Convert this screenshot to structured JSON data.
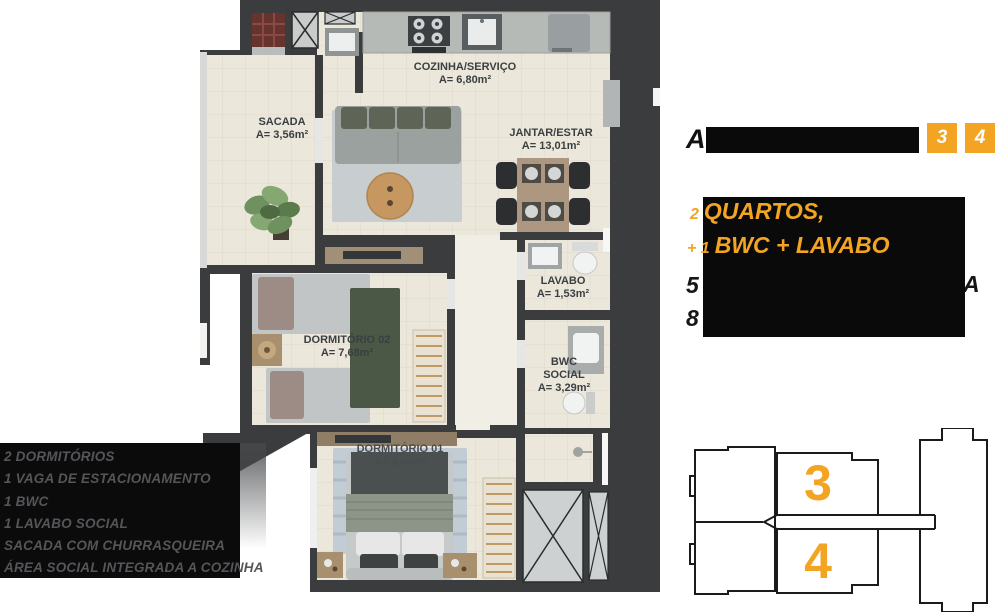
{
  "panel": {
    "accent_color": "#F2A422",
    "title_visible_prefix": "A",
    "unit_badges": [
      "3",
      "4"
    ],
    "highlight": {
      "line1_prefix": "2",
      "line1_text": "QUARTOS,",
      "line2_prefix": "+ 1",
      "line2_text": "BWC + LAVABO"
    },
    "partially_redacted": {
      "line3_prefix": "5",
      "line3_suffix": "A",
      "line4_prefix": "8"
    }
  },
  "features": {
    "items": [
      "2 DORMITÓRIOS",
      "1 VAGA DE ESTACIONAMENTO",
      "1 BWC",
      "1 LAVABO SOCIAL",
      "SACADA COM CHURRASQUEIRA",
      "ÁREA SOCIAL INTEGRADA A COZINHA"
    ]
  },
  "floorplan": {
    "wall_color": "#3A3C3E",
    "floor_color": "#ECE7DB",
    "rooms": [
      {
        "name": "SACADA",
        "area": "A= 3,56m²"
      },
      {
        "name": "COZINHA/SERVIÇO",
        "area": "A= 6,80m²"
      },
      {
        "name": "JANTAR/ESTAR",
        "area": "A= 13,01m²"
      },
      {
        "name": "LAVABO",
        "area": "A= 1,53m²"
      },
      {
        "name": "BWC SOCIAL",
        "area": "A= 3,29m²"
      },
      {
        "name": "DORMITÓRIO 02",
        "area": "A= 7,68m²"
      },
      {
        "name": "DORMITÓRIO 01",
        "area": "A= 9,05m²"
      }
    ]
  },
  "keyplan": {
    "units": [
      "3",
      "4"
    ]
  }
}
